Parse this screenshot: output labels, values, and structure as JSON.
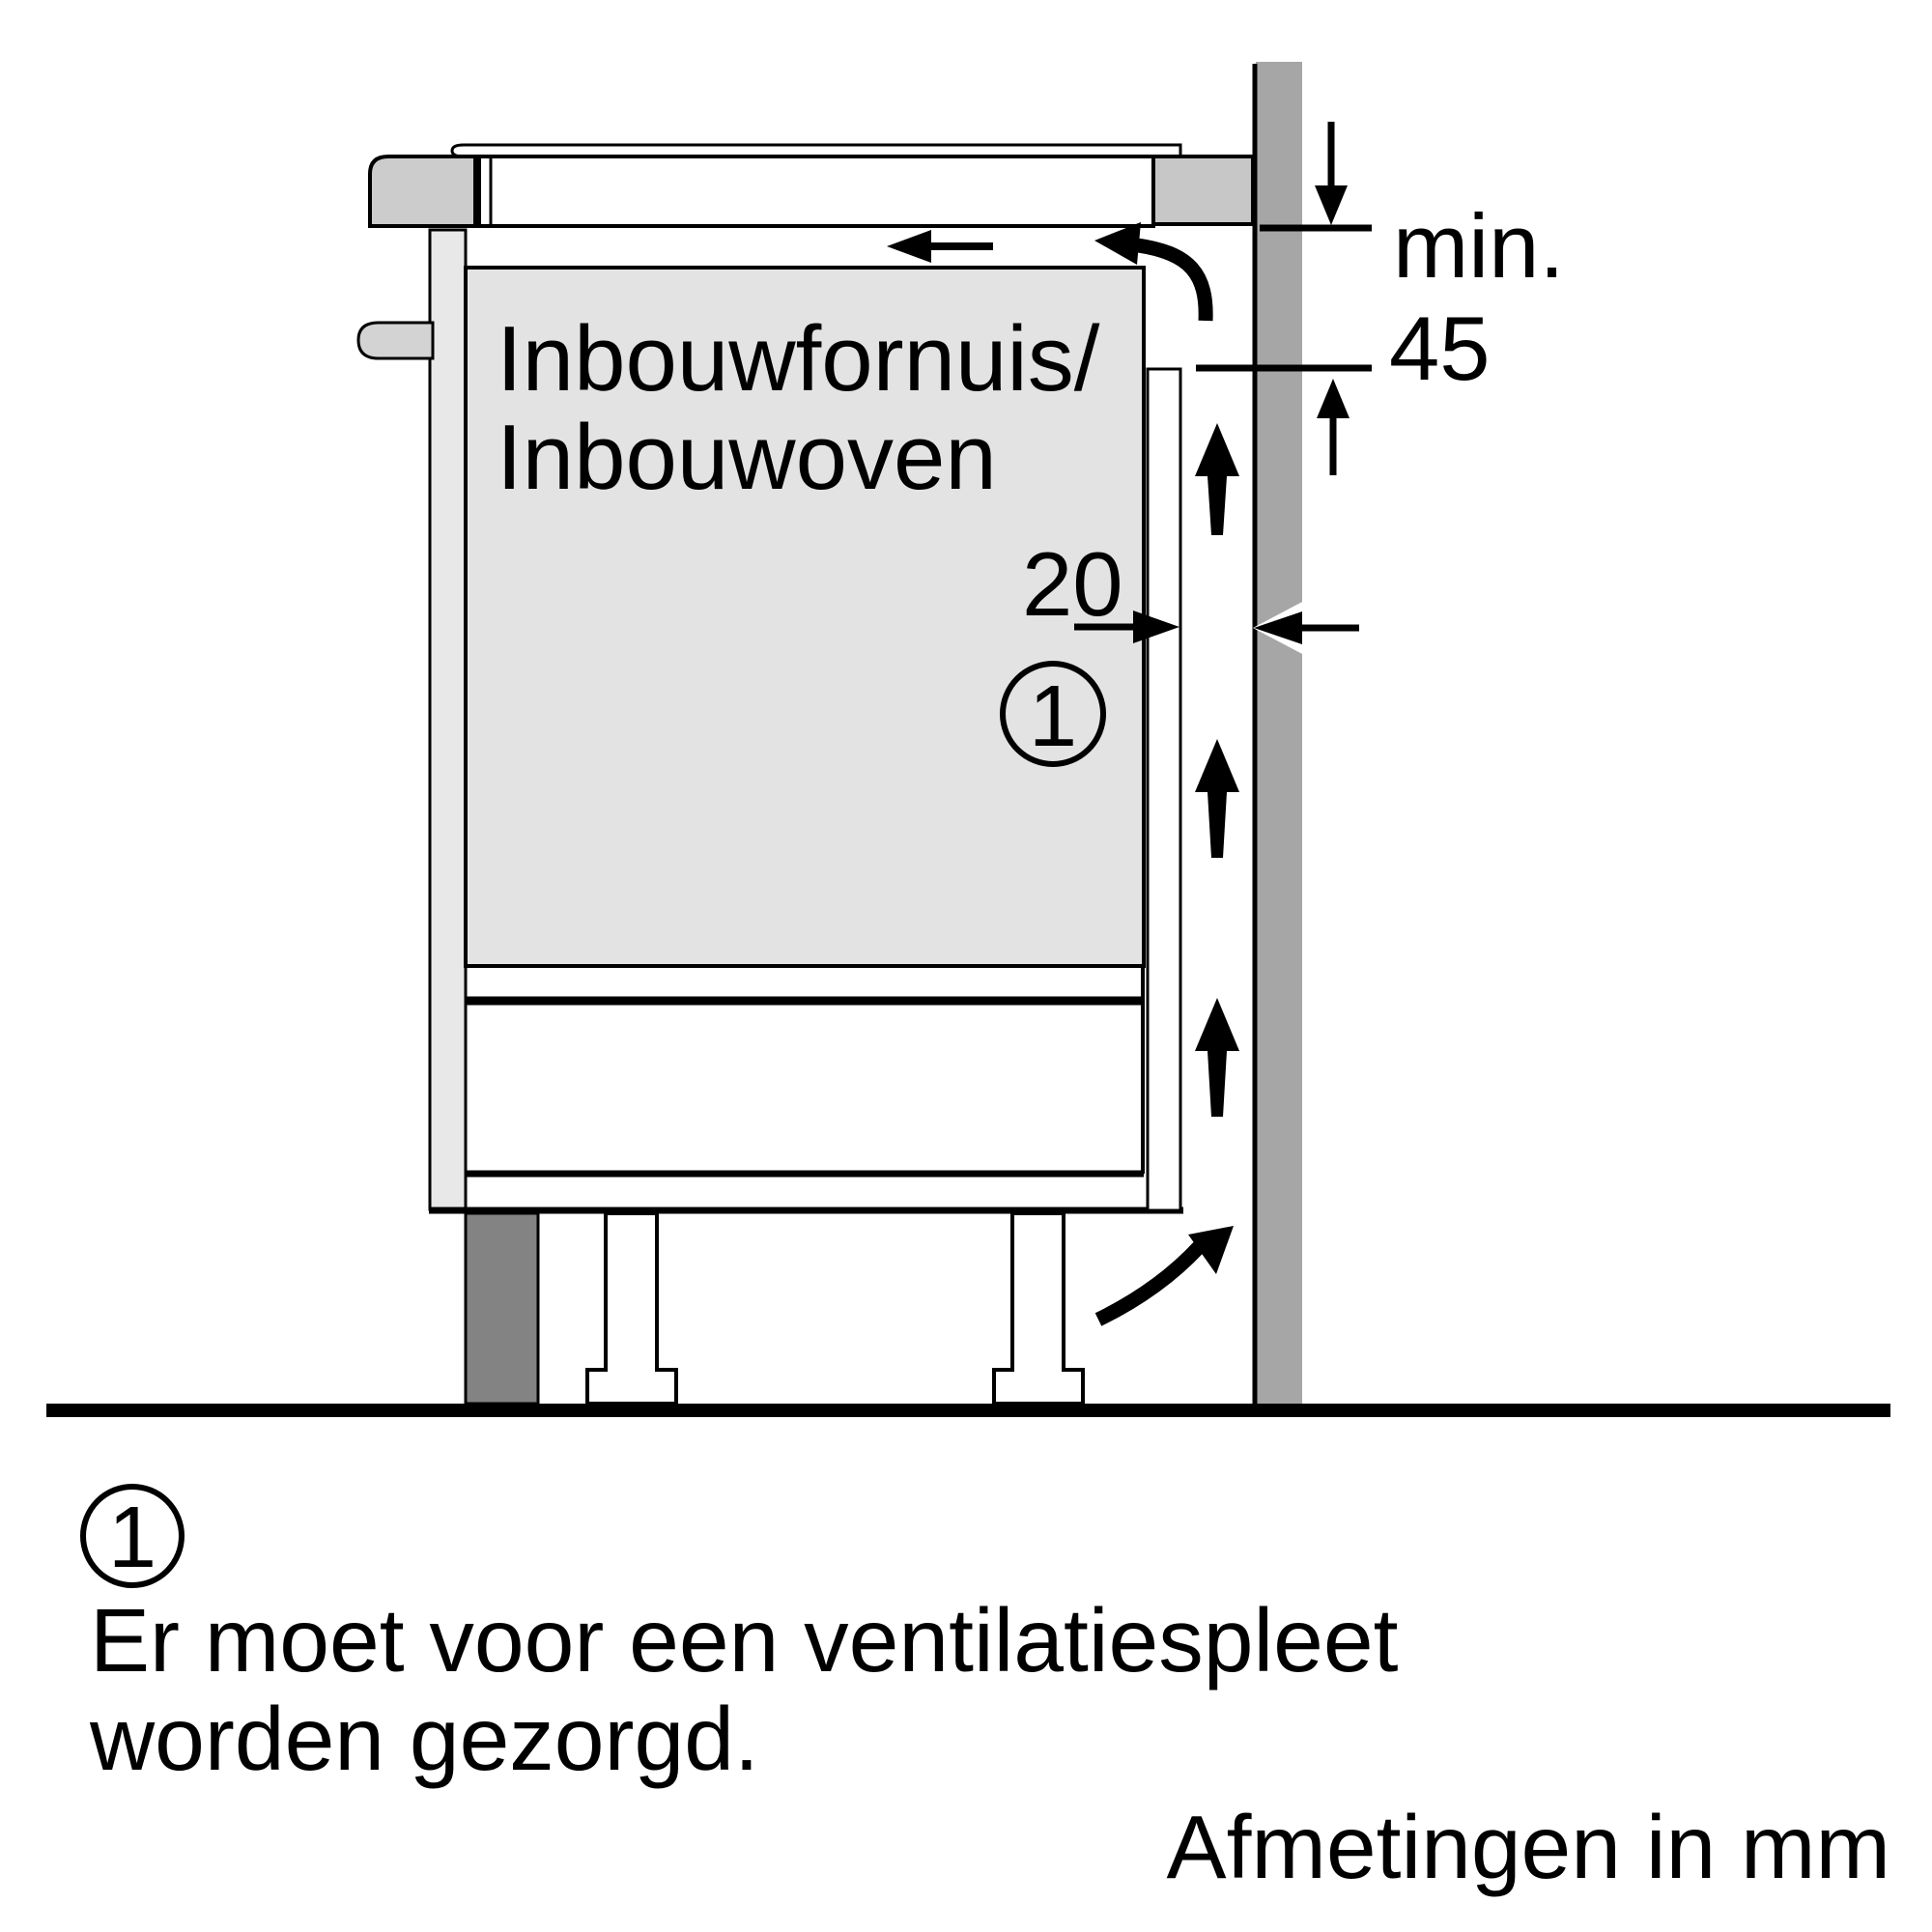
{
  "colors": {
    "background": "#ffffff",
    "wall": "#a6a6a6",
    "cooktop_block_left": "#cccccc",
    "cooktop_block_right": "#c7c7c7",
    "cabinet_panel": "#e8e8e8",
    "oven_body": "#e3e3e3",
    "knob": "#d3d3d3",
    "plinth_leg": "#838383",
    "line": "#000000"
  },
  "cabinet": {
    "label_line1": "Inbouwfornuis/",
    "label_line2": "Inbouwoven"
  },
  "dimensions": {
    "min_label": "min.",
    "min_value": "45",
    "gap_value": "20"
  },
  "callout": {
    "number": "1"
  },
  "legend": {
    "number": "1",
    "line1": "Er moet voor een ventilatiespleet",
    "line2": "worden gezorgd."
  },
  "footer": {
    "units_note": "Afmetingen in mm"
  }
}
